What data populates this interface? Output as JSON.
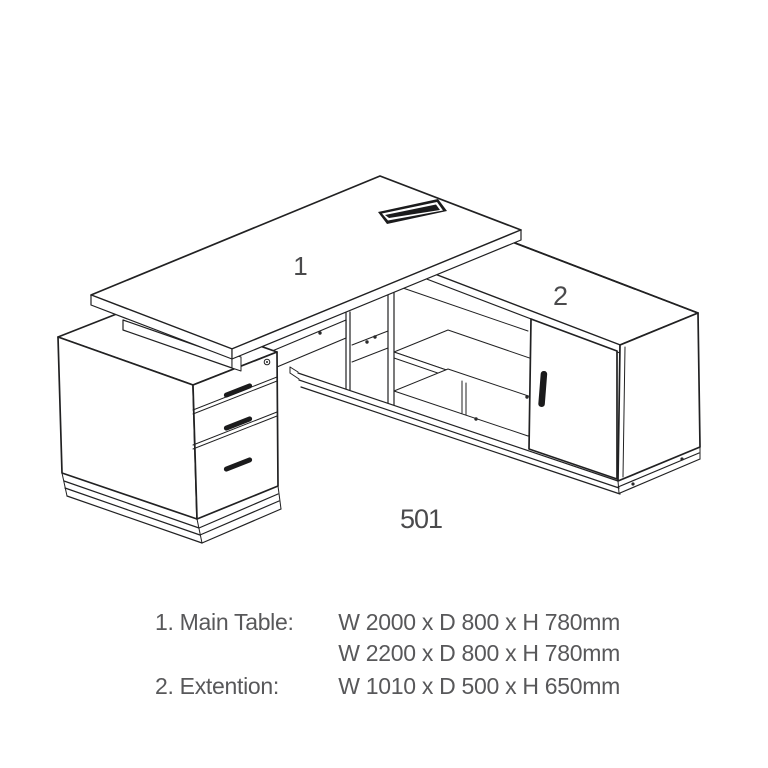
{
  "drawing": {
    "labels": {
      "main_table": "1",
      "extension": "2",
      "model": "501"
    }
  },
  "specs": {
    "items": [
      {
        "label": "1. Main Table:",
        "values": [
          "W 2000 x D 800 x H 780mm",
          "W 2200 x D 800 x H 780mm"
        ]
      },
      {
        "label": "2. Extention:",
        "values": [
          "W 1010 x D 500 x H 650mm"
        ]
      }
    ]
  },
  "colors": {
    "line": "#212122",
    "spec_text": "#58585a",
    "label_text": "#4a4a4c",
    "background": "#ffffff"
  }
}
